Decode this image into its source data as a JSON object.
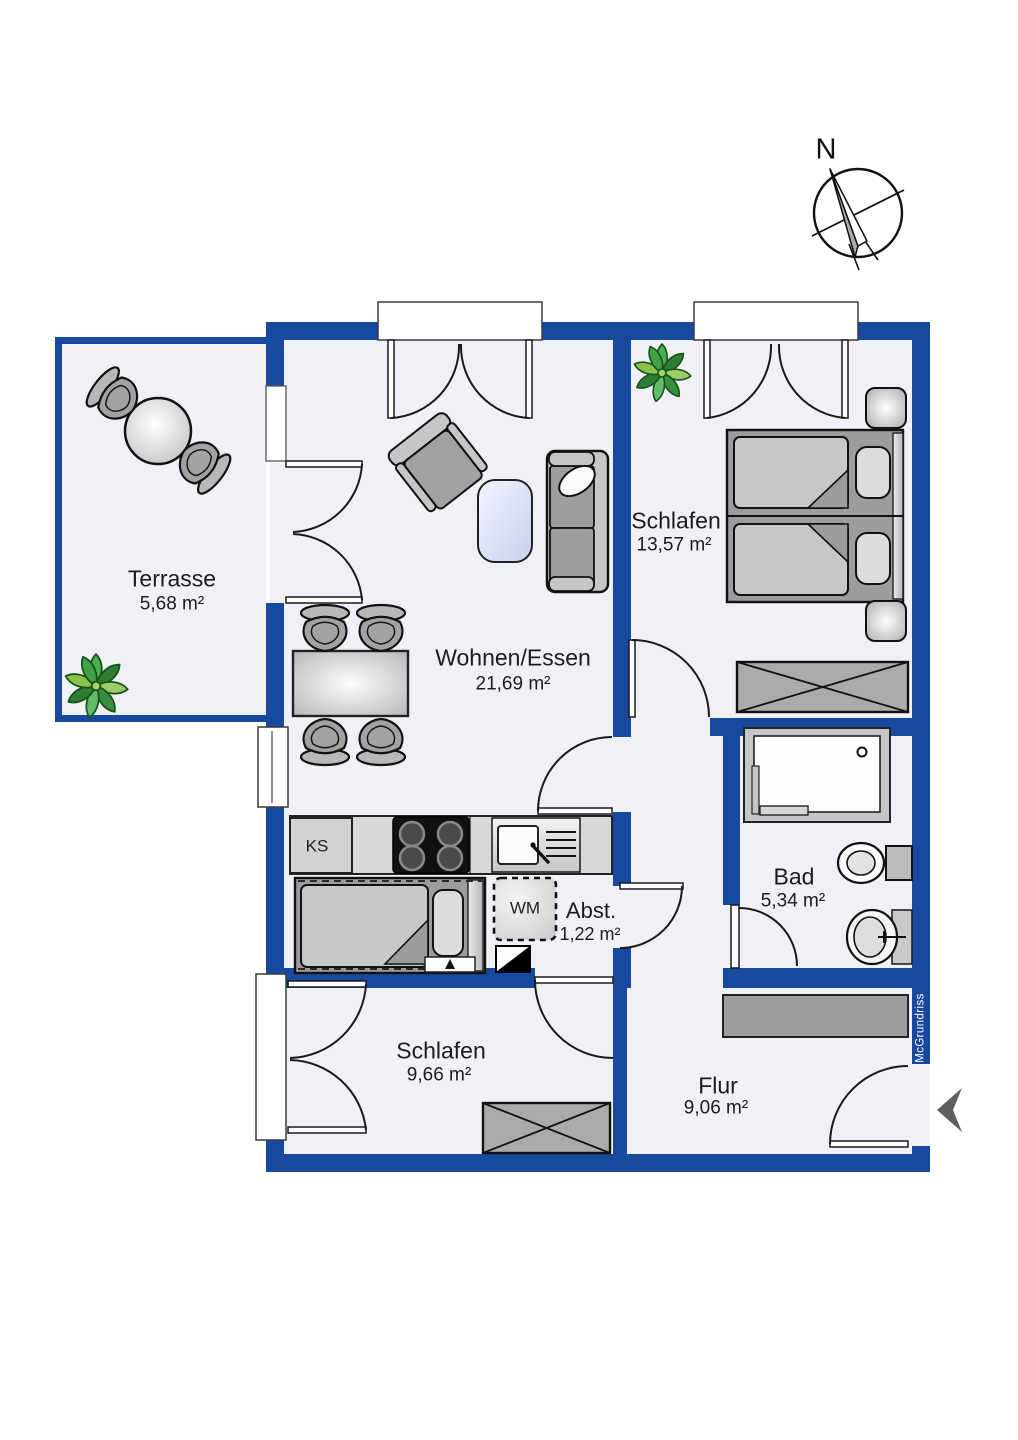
{
  "document": {
    "type": "floor-plan"
  },
  "branding": {
    "watermark": "McGrundriss"
  },
  "compass": {
    "label": "N"
  },
  "rooms": [
    {
      "name": "Terrasse",
      "area": "5,68 m²"
    },
    {
      "name": "Wohnen/Essen",
      "area": "21,69 m²"
    },
    {
      "name": "Schlafen",
      "area": "13,57 m²"
    },
    {
      "name": "Bad",
      "area": "5,34 m²"
    },
    {
      "name": "Abst.",
      "area": "1,22 m²"
    },
    {
      "name": "Schlafen",
      "area": "9,66 m²"
    },
    {
      "name": "Flur",
      "area": "9,06 m²"
    }
  ],
  "appliances": {
    "fridge_label": "KS",
    "washer_label": "WM"
  },
  "colors": {
    "wall_blue": "#17499e",
    "floor_gray": "#f0f1f6",
    "outline": "#1a1a1a",
    "furniture_gray": "#a2a2a2",
    "furniture_light": "#c9c9c9",
    "counter_gray": "#d8d8d8",
    "coffee_table_blue": "#dfe5fa",
    "plant_green": "#3e9d3e",
    "entry_arrow_gray": "#5f5f5f",
    "watermark_text": "#ffffff"
  },
  "icons": [
    "compass-rose",
    "entrance-arrow",
    "plant",
    "round-table",
    "terrace-chair",
    "dining-table",
    "dining-chair",
    "armchair",
    "coffee-table",
    "sofa",
    "double-bed",
    "single-bed",
    "nightstand",
    "wardrobe",
    "kitchen-counter",
    "stove",
    "kitchen-sink",
    "fridge",
    "washing-machine",
    "installation-shaft",
    "shower",
    "toilet",
    "bath-sink",
    "door-swing",
    "french-door",
    "window"
  ]
}
